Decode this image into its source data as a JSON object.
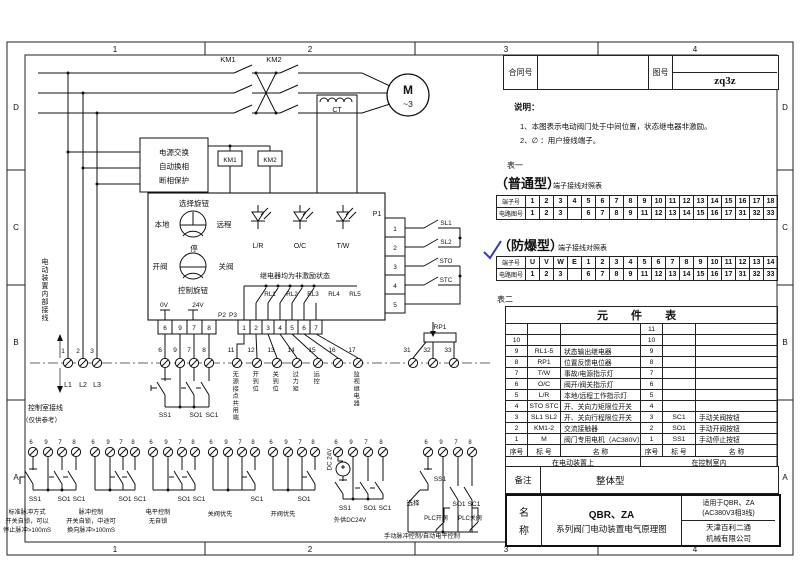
{
  "colors": {
    "line": "#111111",
    "checkmark": "#3b3bb0"
  },
  "frame": {
    "top": [
      "1",
      "2",
      "3",
      "4"
    ],
    "bottom": [
      "1",
      "2",
      "3",
      "4"
    ],
    "left": [
      "D",
      "C",
      "B",
      "A"
    ],
    "right": [
      "D",
      "C",
      "B",
      "A"
    ]
  },
  "title_block": {
    "contract_label": "合同号",
    "drawing_label": "图号",
    "drawing_value": "zq3z"
  },
  "notes": {
    "heading": "说明：",
    "line1": "1、本图表示电动阀门处于中间位置，状态继电器非激励。",
    "line2": "2、∅ ：用户接线端子。"
  },
  "table1": {
    "label": "表一",
    "heading": "（普通型）",
    "subheading": "端子接线对照表",
    "row1_label": "端子号",
    "row2_label": "电路图号",
    "terminals": [
      "1",
      "2",
      "3",
      "4",
      "5",
      "6",
      "7",
      "8",
      "9",
      "10",
      "11",
      "12",
      "13",
      "14",
      "15",
      "16",
      "17",
      "18"
    ],
    "circuits": [
      "1",
      "2",
      "3",
      "",
      "6",
      "7",
      "8",
      "9",
      "11",
      "12",
      "13",
      "14",
      "15",
      "16",
      "17",
      "31",
      "32",
      "33"
    ]
  },
  "table2": {
    "checkmark": "✓",
    "heading": "（防爆型）",
    "subheading": "端子接线对照表",
    "row1_label": "端子号",
    "row2_label": "电路图号",
    "terminals": [
      "U",
      "V",
      "W",
      "E",
      "1",
      "2",
      "3",
      "4",
      "5",
      "6",
      "7",
      "8",
      "9",
      "10",
      "11",
      "12",
      "13",
      "14"
    ],
    "circuits": [
      "1",
      "2",
      "3",
      "",
      "6",
      "7",
      "8",
      "9",
      "11",
      "12",
      "13",
      "14",
      "15",
      "16",
      "17",
      "31",
      "32",
      "33"
    ]
  },
  "element_table": {
    "label": "表二",
    "title": "元 件 表",
    "header": {
      "no": "序号",
      "tag": "标 号",
      "name": "名    称"
    },
    "rows": [
      {
        "l_no": "",
        "l_tag": "",
        "l_name": "",
        "r_no": "11",
        "r_tag": "",
        "r_name": ""
      },
      {
        "l_no": "10",
        "l_tag": "",
        "l_name": "",
        "r_no": "10",
        "r_tag": "",
        "r_name": ""
      },
      {
        "l_no": "9",
        "l_tag": "RL1-5",
        "l_name": "状态输出继电器",
        "r_no": "9",
        "r_tag": "",
        "r_name": ""
      },
      {
        "l_no": "8",
        "l_tag": "RP1",
        "l_name": "位置反馈电位器",
        "r_no": "8",
        "r_tag": "",
        "r_name": ""
      },
      {
        "l_no": "7",
        "l_tag": "T/W",
        "l_name": "事故/电源指示灯",
        "r_no": "7",
        "r_tag": "",
        "r_name": ""
      },
      {
        "l_no": "6",
        "l_tag": "O/C",
        "l_name": "阀开/阀关指示灯",
        "r_no": "6",
        "r_tag": "",
        "r_name": ""
      },
      {
        "l_no": "5",
        "l_tag": "L/R",
        "l_name": "本地/远程工作指示灯",
        "r_no": "5",
        "r_tag": "",
        "r_name": ""
      },
      {
        "l_no": "4",
        "l_tag": "STO STC",
        "l_name": "开、关向力矩限位开关",
        "r_no": "4",
        "r_tag": "",
        "r_name": ""
      },
      {
        "l_no": "3",
        "l_tag": "SL1 SL2",
        "l_name": "开、关向行程限位开关",
        "r_no": "3",
        "r_tag": "SC1",
        "r_name": "手动关阀按钮"
      },
      {
        "l_no": "2",
        "l_tag": "KM1-2",
        "l_name": "交流接触器",
        "r_no": "2",
        "r_tag": "SO1",
        "r_name": "手动开阀按钮"
      },
      {
        "l_no": "1",
        "l_tag": "M",
        "l_name": "阀门专用电机（AC380V）",
        "r_no": "1",
        "r_tag": "SS1",
        "r_name": "手动停止按钮"
      }
    ],
    "footer_left": "在电动装置上",
    "footer_right": "在控制室内"
  },
  "remarks": {
    "label": "备注",
    "value": "整体型"
  },
  "name_block": {
    "label_top": "名",
    "label_bottom": "称",
    "model": "QBR、ZA",
    "title": "系列阀门电动装置电气原理图",
    "apply1": "适用于QBR、ZA",
    "apply2": "(AC380V3相3线)",
    "company1": "天津百利二通",
    "company2": "机械有限公司"
  },
  "schematic": {
    "km1": "KM1",
    "km2": "KM2",
    "ct": "CT",
    "motor": "M",
    "motor_phase": "~3",
    "pb1": "电源交换",
    "pb2": "自动换相",
    "pb3": "断相保护",
    "km1_coil": "KM1",
    "km2_coil": "KM2",
    "sel_title": "选择旋钮",
    "local": "本地",
    "remote": "远程",
    "stop": "停",
    "open_label": "开阀",
    "close_label": "关阀",
    "ctrl_title": "控制旋钮",
    "lamp1": "L/R",
    "lamp2": "O/C",
    "lamp3": "T/W",
    "relay_note": "继电器均为非激励状态",
    "rl1": "RL1",
    "rl2": "RL2",
    "rl3": "RL3",
    "rl4": "RL4",
    "rl5": "RL5",
    "p1": "P1",
    "p1c1": "1",
    "p1c2": "2",
    "p1c3": "3",
    "p1c4": "4",
    "p1c5": "5",
    "sl1": "SL1",
    "sl2": "SL2",
    "sto": "STO",
    "stc": "STC",
    "v0": "0V",
    "v24": "24V",
    "p2": "P2",
    "p3": "P3",
    "p2c1": "6",
    "p2c2": "9",
    "p2c3": "7",
    "p2c4": "8",
    "p3c1": "1",
    "p3c2": "2",
    "p3c3": "3",
    "p3c4": "4",
    "p3c5": "5",
    "p3c6": "6",
    "p3c7": "7",
    "t1": "1",
    "t2": "2",
    "t3": "3",
    "l1": "L1",
    "l2": "L2",
    "l3": "L3",
    "t6": "6",
    "t9": "9",
    "t7": "7",
    "t8": "8",
    "t11": "11",
    "t12": "12",
    "t13": "13",
    "t14": "14",
    "t15": "15",
    "t16": "16",
    "t17": "17",
    "t31": "31",
    "t32": "32",
    "t33": "33",
    "rp1": "RP1",
    "vl11": "无源接点共用端",
    "vl12": "开到位",
    "vl13": "关到位",
    "vl14": "过力矩",
    "vl15": "远控",
    "vl17": "监视继电器",
    "inner_wiring": "电动装置内部接线",
    "room_wiring": "控制室接线",
    "reference_note": "（仅供参考）",
    "ss1": "SS1",
    "so1": "SO1",
    "sc1": "SC1",
    "gt6": "6",
    "gt9": "9",
    "gt7": "7",
    "gt8": "8",
    "g1": {
      "s1": "SS1",
      "s2": "SO1",
      "s3": "SC1",
      "c1": "标准脉冲方式",
      "c2": "开关自锁，可以",
      "c3": "停止脉冲>100mS"
    },
    "g2": {
      "s2": "SO1",
      "s3": "SC1",
      "c1": "脉冲控制",
      "c2": "开关自锁，中途可",
      "c3": "换向脉冲>100mS"
    },
    "g3": {
      "s2": "SO1",
      "s3": "SC1",
      "c1": "电平控制",
      "c2": "无自锁"
    },
    "g4": {
      "s3": "SC1",
      "c1": "关阀优先"
    },
    "g5": {
      "s2": "SO1",
      "c1": "开阀优先"
    },
    "g6": {
      "dc": "DC 24V",
      "s1": "SS1",
      "s2": "SO1",
      "s3": "SC1",
      "c1": "外供DC24V"
    },
    "g7": {
      "s1": "SS1",
      "sel": "选择",
      "s2": "SO1",
      "s3": "SC1",
      "plc_open": "PLC开阀",
      "plc_close": "PLC关阀",
      "c1": "手动脉冲控制/自动电平控制"
    }
  }
}
